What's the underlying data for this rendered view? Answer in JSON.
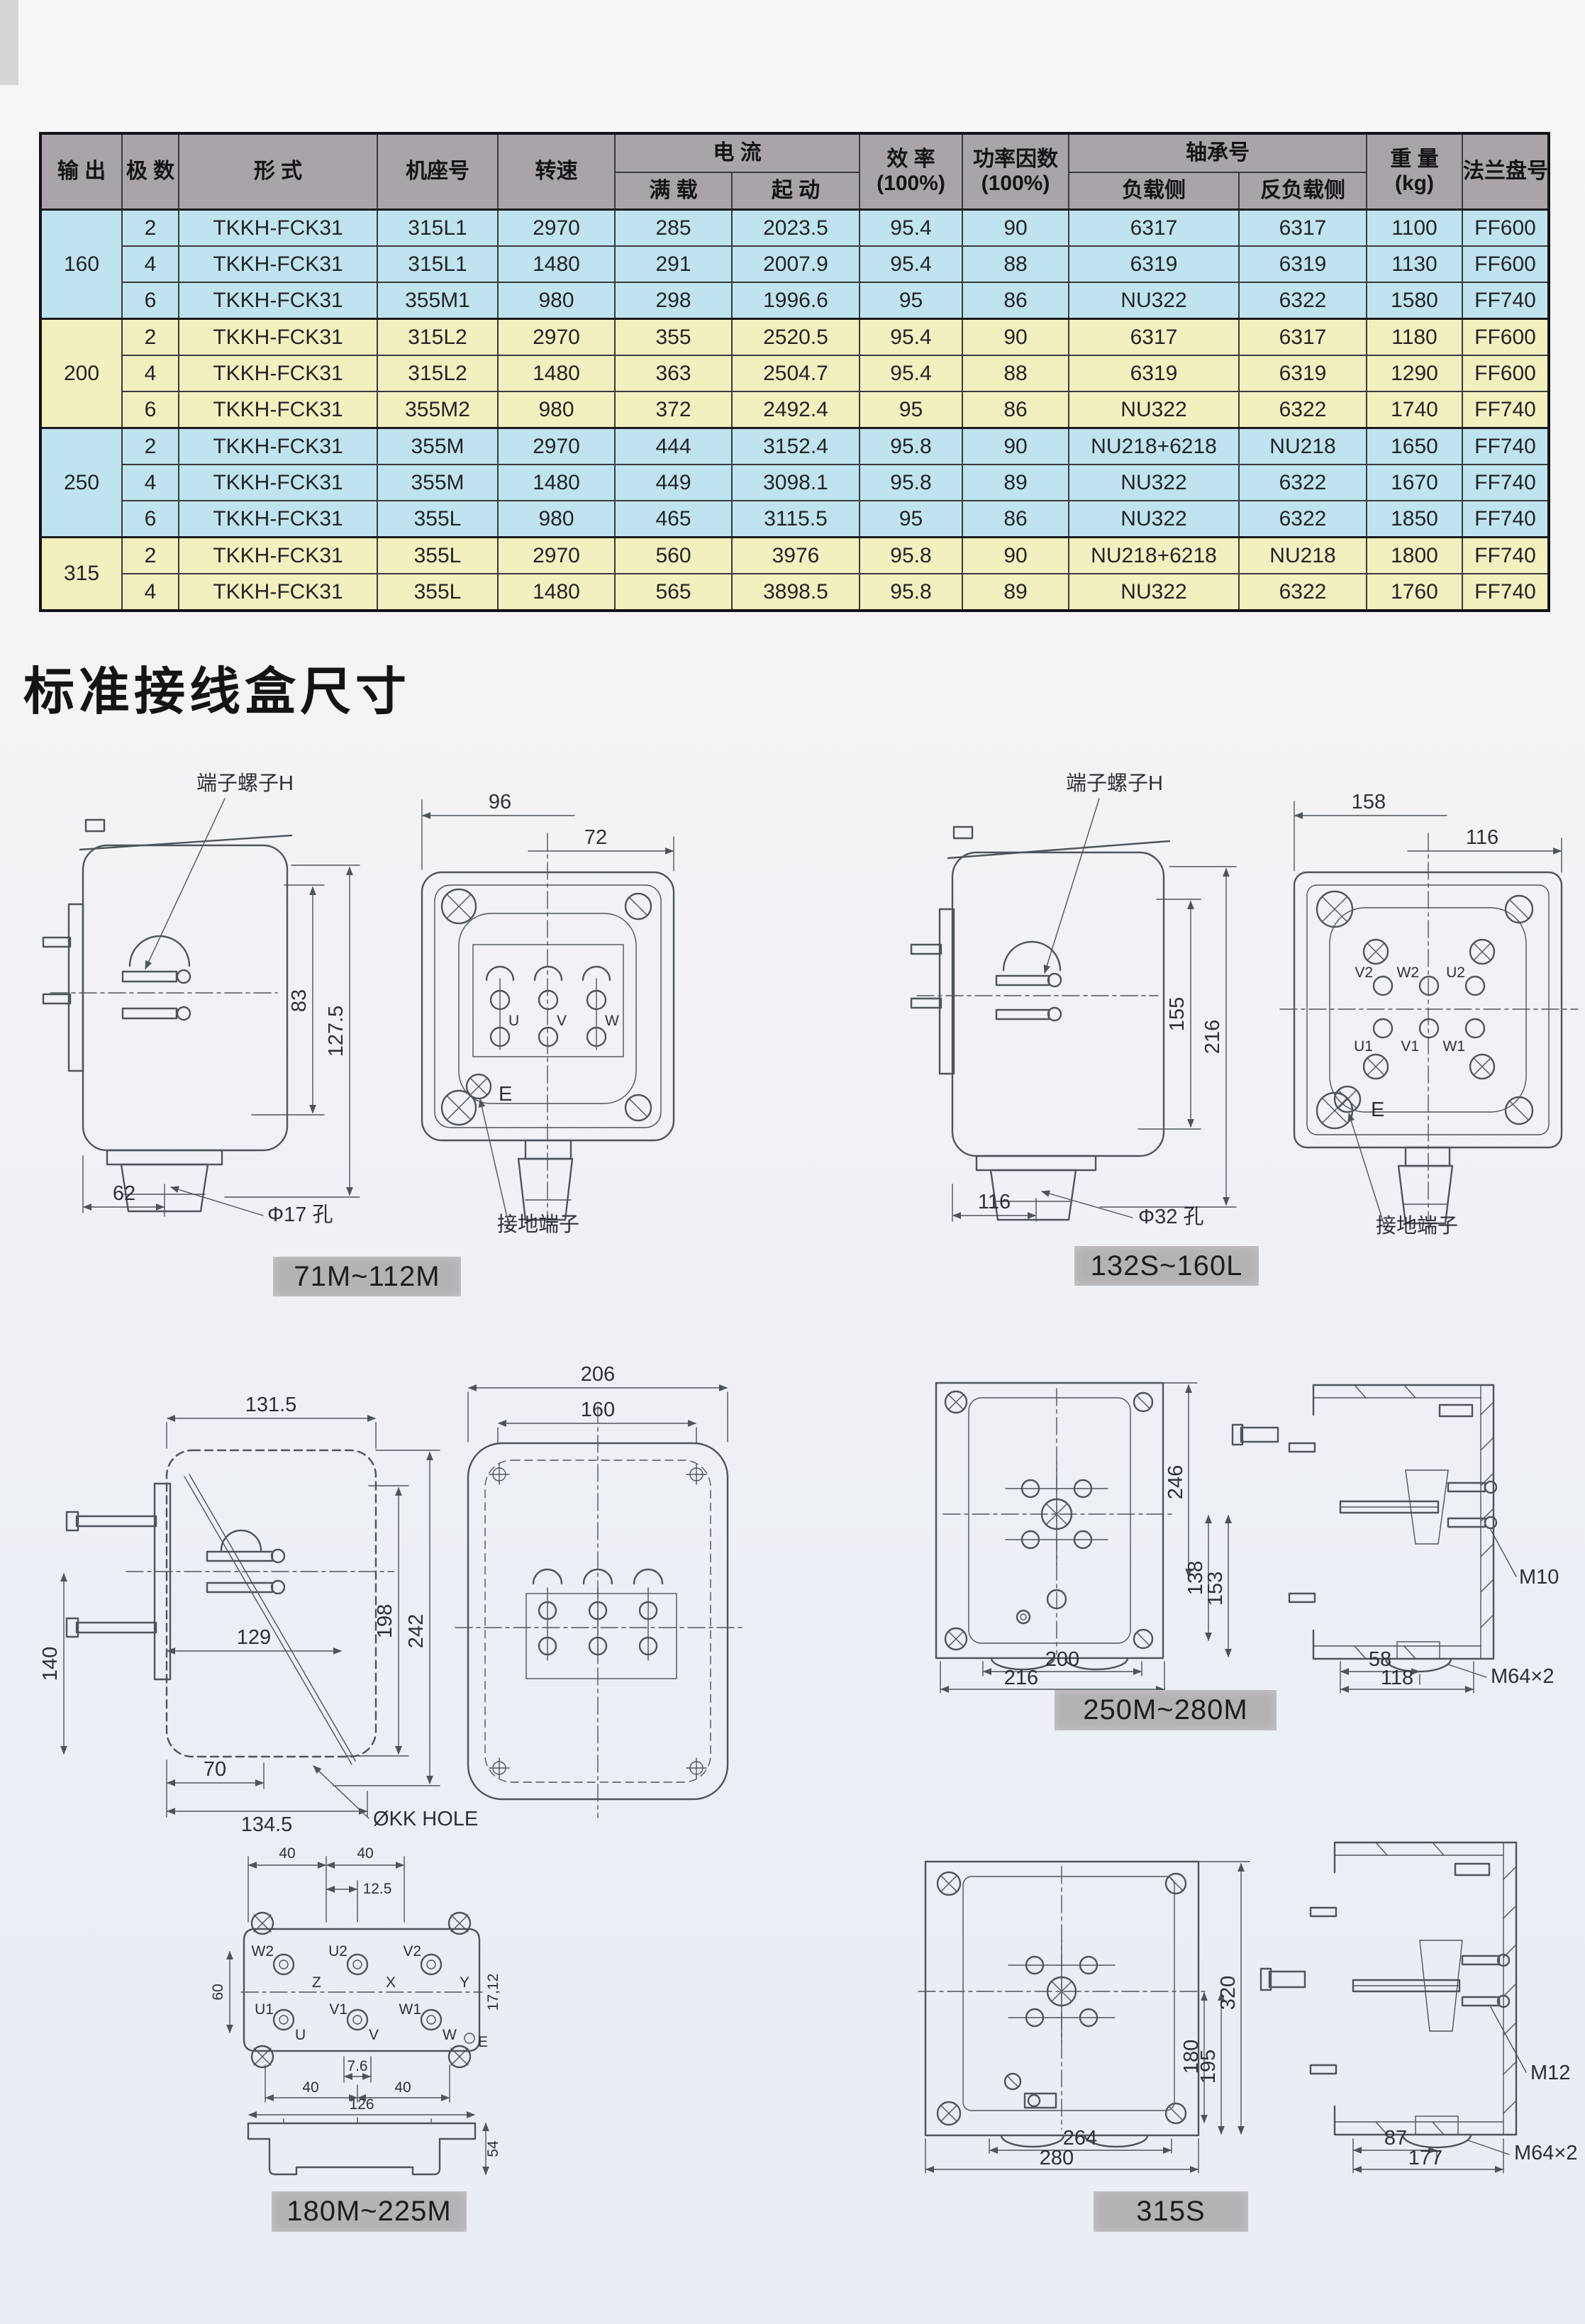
{
  "title": {
    "section": "标准接线盒尺寸"
  },
  "table": {
    "headers": {
      "output": "输 出",
      "poles": "极 数",
      "type": "形 式",
      "frame": "机座号",
      "speed": "转速",
      "current": "电 流",
      "full_load": "满 载",
      "starting": "起 动",
      "efficiency_l1": "效 率",
      "efficiency_l2": "(100%)",
      "power_factor_l1": "功率因数",
      "power_factor_l2": "(100%)",
      "bearing": "轴承号",
      "load_side": "负载侧",
      "anti_load_side": "反负载侧",
      "weight_l1": "重 量",
      "weight_l2": "(kg)",
      "flange": "法兰盘号"
    },
    "groups": [
      {
        "output": "160",
        "color": "blue",
        "rows": [
          [
            "2",
            "TKKH-FCK31",
            "315L1",
            "2970",
            "285",
            "2023.5",
            "95.4",
            "90",
            "6317",
            "6317",
            "1100",
            "FF600"
          ],
          [
            "4",
            "TKKH-FCK31",
            "315L1",
            "1480",
            "291",
            "2007.9",
            "95.4",
            "88",
            "6319",
            "6319",
            "1130",
            "FF600"
          ],
          [
            "6",
            "TKKH-FCK31",
            "355M1",
            "980",
            "298",
            "1996.6",
            "95",
            "86",
            "NU322",
            "6322",
            "1580",
            "FF740"
          ]
        ]
      },
      {
        "output": "200",
        "color": "yellow",
        "rows": [
          [
            "2",
            "TKKH-FCK31",
            "315L2",
            "2970",
            "355",
            "2520.5",
            "95.4",
            "90",
            "6317",
            "6317",
            "1180",
            "FF600"
          ],
          [
            "4",
            "TKKH-FCK31",
            "315L2",
            "1480",
            "363",
            "2504.7",
            "95.4",
            "88",
            "6319",
            "6319",
            "1290",
            "FF600"
          ],
          [
            "6",
            "TKKH-FCK31",
            "355M2",
            "980",
            "372",
            "2492.4",
            "95",
            "86",
            "NU322",
            "6322",
            "1740",
            "FF740"
          ]
        ]
      },
      {
        "output": "250",
        "color": "blue",
        "rows": [
          [
            "2",
            "TKKH-FCK31",
            "355M",
            "2970",
            "444",
            "3152.4",
            "95.8",
            "90",
            "NU218+6218",
            "NU218",
            "1650",
            "FF740"
          ],
          [
            "4",
            "TKKH-FCK31",
            "355M",
            "1480",
            "449",
            "3098.1",
            "95.8",
            "89",
            "NU322",
            "6322",
            "1670",
            "FF740"
          ],
          [
            "6",
            "TKKH-FCK31",
            "355L",
            "980",
            "465",
            "3115.5",
            "95",
            "86",
            "NU322",
            "6322",
            "1850",
            "FF740"
          ]
        ]
      },
      {
        "output": "315",
        "color": "yellow",
        "rows": [
          [
            "2",
            "TKKH-FCK31",
            "355L",
            "2970",
            "560",
            "3976",
            "95.8",
            "90",
            "NU218+6218",
            "NU218",
            "1800",
            "FF740"
          ],
          [
            "4",
            "TKKH-FCK31",
            "355L",
            "1480",
            "565",
            "3898.5",
            "95.8",
            "89",
            "NU322",
            "6322",
            "1760",
            "FF740"
          ]
        ]
      }
    ]
  },
  "diagrams": {
    "a": {
      "screw": "端子螺子H",
      "d83": "83",
      "d127": "127.5",
      "d62": "62",
      "hole": "Φ17 孔"
    },
    "b": {
      "d96": "96",
      "d72": "72",
      "u": "U",
      "v": "V",
      "w": "W",
      "e": "E",
      "ground": "接地端子"
    },
    "label_a": "71M~112M",
    "c": {
      "screw": "端子螺子H",
      "d155": "155",
      "d216": "216",
      "d116": "116",
      "hole": "Φ32 孔"
    },
    "d": {
      "d158": "158",
      "d116": "116",
      "t": [
        "V2",
        "W2",
        "U2",
        "U1",
        "V1",
        "W1"
      ],
      "e": "E",
      "ground": "接地端子"
    },
    "label_b": "132S~160L",
    "e": {
      "d131": "131.5",
      "d129": "129",
      "d198": "198",
      "d242": "242",
      "d140": "140",
      "d70": "70",
      "d134": "134.5",
      "hole": "ØKK HOLE"
    },
    "f": {
      "d206": "206",
      "d160": "160"
    },
    "g": {
      "d246": "246",
      "d138": "138",
      "d153": "153",
      "d200": "200",
      "d216": "216",
      "d58": "58",
      "d118": "118",
      "m10": "M10",
      "m64": "M64×2"
    },
    "label_c": "250M~280M",
    "h": {
      "d40a": "40",
      "d40b": "40",
      "d125": "12.5",
      "d60": "60",
      "d1712": "17,12",
      "d76": "7.6",
      "d40c": "40",
      "d40d": "40",
      "d126": "126",
      "d54": "54",
      "t": [
        "W2",
        "U2",
        "V2",
        "U1",
        "V1",
        "W1"
      ],
      "links": [
        "Z",
        "X",
        "Y"
      ],
      "phases": [
        "U",
        "V",
        "W"
      ],
      "e": "E"
    },
    "label_d": "180M~225M",
    "i": {
      "d320": "320",
      "d180": "180",
      "d195": "195",
      "d264": "264",
      "d280": "280",
      "d87": "87",
      "d177": "177",
      "m12": "M12",
      "m64": "M64×2"
    },
    "label_e": "315S"
  },
  "colors": {
    "row_blue": "#bfe4ef",
    "row_yellow": "#f3f0bf",
    "header_gray": "#a8a4a9",
    "label_gray": "#b5b2b6",
    "line": "#4e545c"
  }
}
